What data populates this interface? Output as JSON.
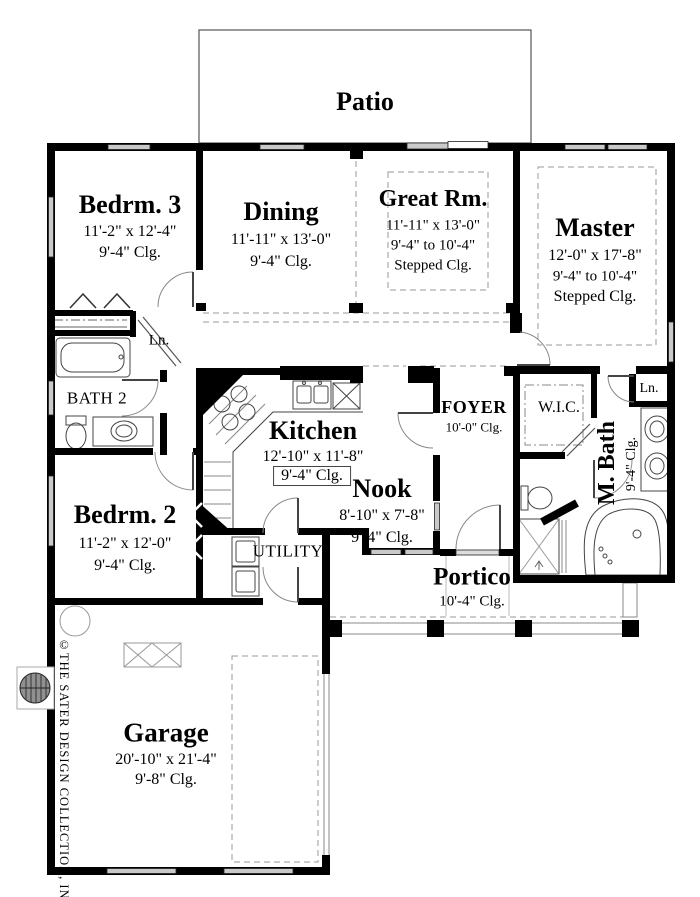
{
  "plan": {
    "patio": {
      "name": "Patio"
    },
    "bedrm3": {
      "name": "Bedrm. 3",
      "dims": "11'-2\" x 12'-4\"",
      "clg": "9'-4\" Clg."
    },
    "dining": {
      "name": "Dining",
      "dims": "11'-11\" x 13'-0\"",
      "clg": "9'-4\" Clg."
    },
    "great_rm": {
      "name": "Great Rm.",
      "dims": "11'-11\" x 13'-0\"",
      "clg_range": "9'-4\" to 10'-4\"",
      "clg_type": "Stepped Clg."
    },
    "master": {
      "name": "Master",
      "dims": "12'-0\" x 17'-8\"",
      "clg_range": "9'-4\" to 10'-4\"",
      "clg_type": "Stepped Clg."
    },
    "linen_hall": {
      "name": "Ln."
    },
    "bath2": {
      "name": "BATH 2"
    },
    "kitchen": {
      "name": "Kitchen",
      "dims": "12'-10\" x 11'-8\"",
      "clg": "9'-4\" Clg."
    },
    "nook": {
      "name": "Nook",
      "dims": "8'-10\" x 7'-8\"",
      "clg": "9'-4\" Clg."
    },
    "foyer": {
      "name": "FOYER",
      "clg": "10'-0\" Clg."
    },
    "wic": {
      "name": "W.I.C."
    },
    "linen_master": {
      "name": "Ln."
    },
    "master_bath": {
      "name": "M. Bath",
      "clg": "9'-4\" Clg."
    },
    "bedrm2": {
      "name": "Bedrm. 2",
      "dims": "11'-2\" x 12'-0\"",
      "clg": "9'-4\" Clg."
    },
    "utility": {
      "name": "UTILITY"
    },
    "portico": {
      "name": "Portico",
      "clg": "10'-4\" Clg."
    },
    "garage": {
      "name": "Garage",
      "dims": "20'-10\" x 21'-4\"",
      "clg": "9'-8\" Clg."
    }
  },
  "branding": {
    "copyright": "©THE SATER DESIGN COLLECTION, INC."
  },
  "colors": {
    "wall": "#000000",
    "window_fill": "#c9c9c9",
    "dash": "#999999",
    "paper": "#ffffff"
  }
}
